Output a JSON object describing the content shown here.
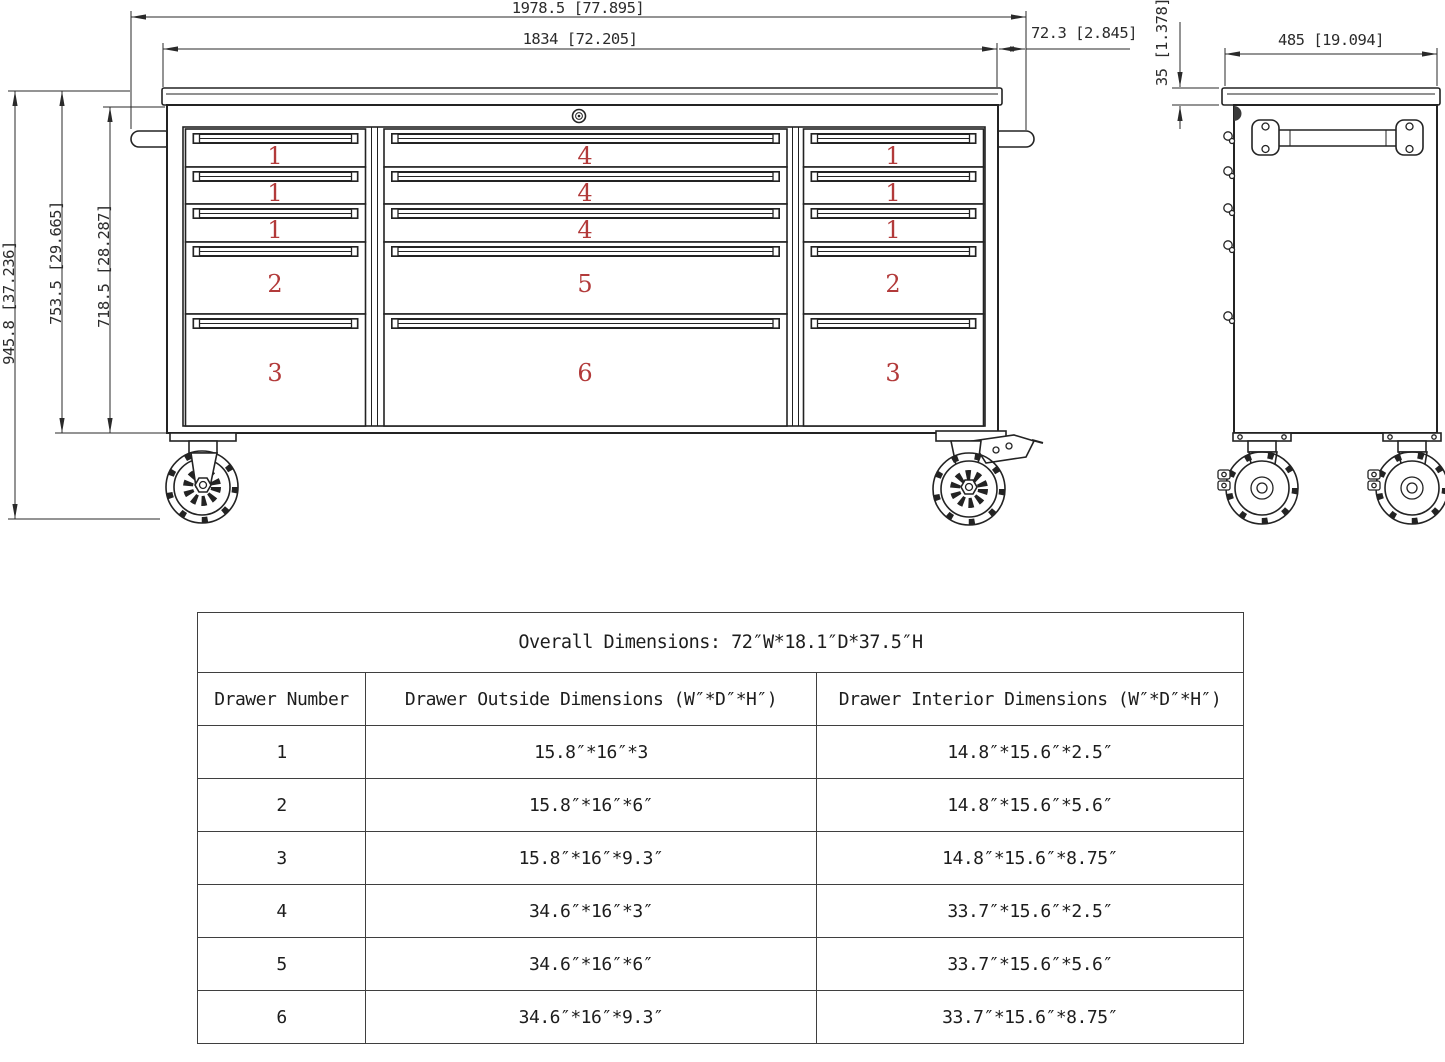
{
  "drawing": {
    "dimensions": {
      "overall_width": "1978.5 [77.895]",
      "top_width": "1834 [72.205]",
      "top_overhang": "72.3 [2.845]",
      "overall_height": "945.8 [37.236]",
      "body_height": "753.5 [29.665]",
      "drawer_area_height": "718.5 [28.287]",
      "side_depth": "485 [19.094]",
      "top_thickness": "35 [1.378]"
    },
    "front_view": {
      "left_column": [
        "1",
        "1",
        "1",
        "2",
        "3"
      ],
      "middle_column": [
        "4",
        "4",
        "4",
        "5",
        "6"
      ],
      "right_column": [
        "1",
        "1",
        "1",
        "2",
        "3"
      ]
    },
    "colors": {
      "line": "#232323",
      "drawer_number": "#b23a3a"
    }
  },
  "table": {
    "title": "Overall Dimensions: 72″W*18.1″D*37.5″H",
    "headers": [
      "Drawer Number",
      "Drawer Outside Dimensions (W″*D″*H″)",
      "Drawer Interior Dimensions (W″*D″*H″)"
    ],
    "rows": [
      [
        "1",
        "15.8″*16″*3",
        "14.8″*15.6″*2.5″"
      ],
      [
        "2",
        "15.8″*16″*6″",
        "14.8″*15.6″*5.6″"
      ],
      [
        "3",
        "15.8″*16″*9.3″",
        "14.8″*15.6″*8.75″"
      ],
      [
        "4",
        "34.6″*16″*3″",
        "33.7″*15.6″*2.5″"
      ],
      [
        "5",
        "34.6″*16″*6″",
        "33.7″*15.6″*5.6″"
      ],
      [
        "6",
        "34.6″*16″*9.3″",
        "33.7″*15.6″*8.75″"
      ]
    ]
  }
}
